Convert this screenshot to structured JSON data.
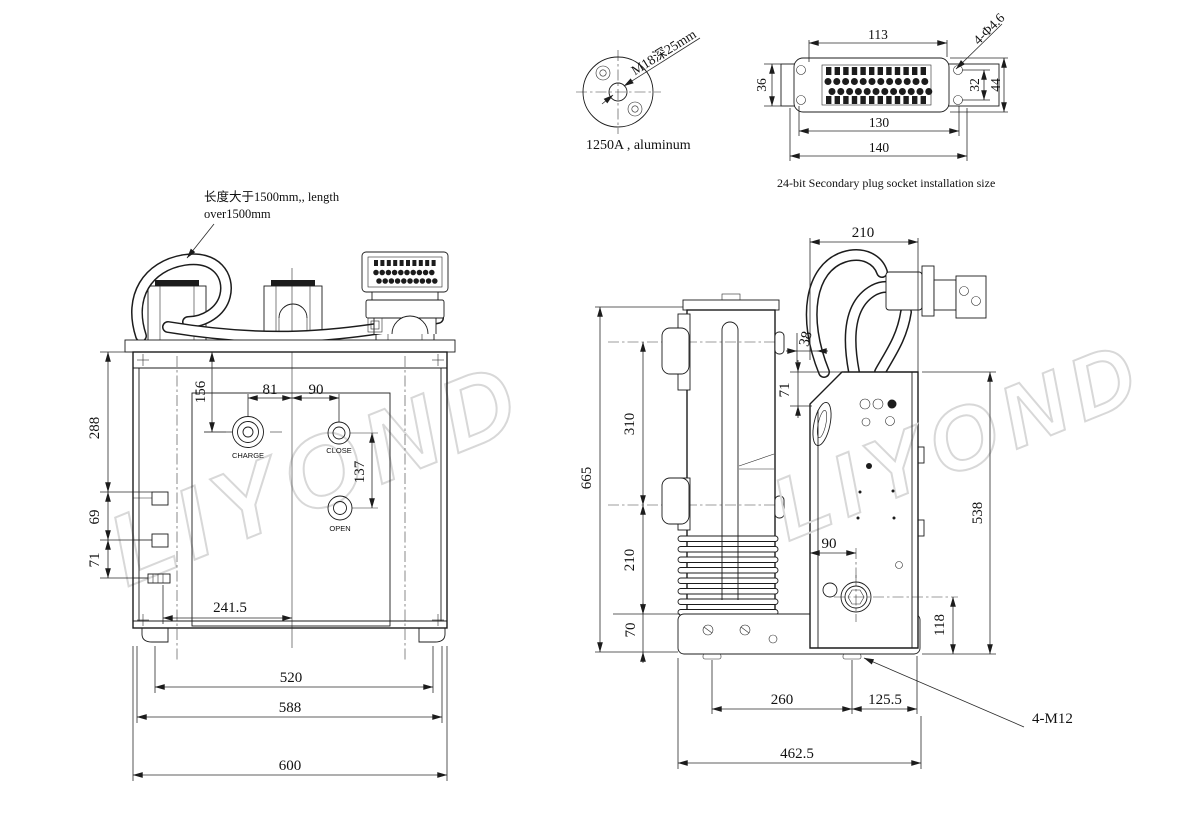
{
  "watermark": {
    "text": "LIYOND"
  },
  "terminal_detail": {
    "thread_label": "M18深25mm",
    "caption": "1250A , aluminum"
  },
  "plug_socket": {
    "caption": "24-bit Secondary plug socket installation size",
    "dim_pin_width": "113",
    "dim_holes": "4-Φ4.6",
    "dim_flange_height": "36",
    "dim_inner_height": "32",
    "dim_total_height": "44",
    "dim_hole_span": "130",
    "dim_total_width": "140"
  },
  "cable_note": {
    "line1": "长度大于1500mm,, length",
    "line2": "over1500mm"
  },
  "front_view": {
    "charge_label": "CHARGE",
    "close_label": "CLOSE",
    "open_label": "OPEN",
    "dim_top_to_charge": "156",
    "dim_charge_to_center": "81",
    "dim_center_to_close": "90",
    "dim_close_to_open": "137",
    "dim_side_upper": "288",
    "dim_side_mid": "69",
    "dim_side_lower": "71",
    "dim_panel_width": "241.5",
    "dim_feet_span": "520",
    "dim_body_width": "588",
    "dim_overall_width": "600"
  },
  "side_view": {
    "dim_depth_top": "210",
    "dim_gap": "38",
    "dim_box_top": "71",
    "dim_overall_height": "665",
    "dim_pole_upper": "310",
    "dim_pole_lower": "210",
    "dim_base_height": "70",
    "dim_box_height": "538",
    "dim_shaft_to_base": "118",
    "dim_shaft_offset": "90",
    "dim_feet_span": "260",
    "dim_foot_to_edge": "125.5",
    "dim_base_depth": "462.5",
    "bolt_label": "4-M12"
  }
}
